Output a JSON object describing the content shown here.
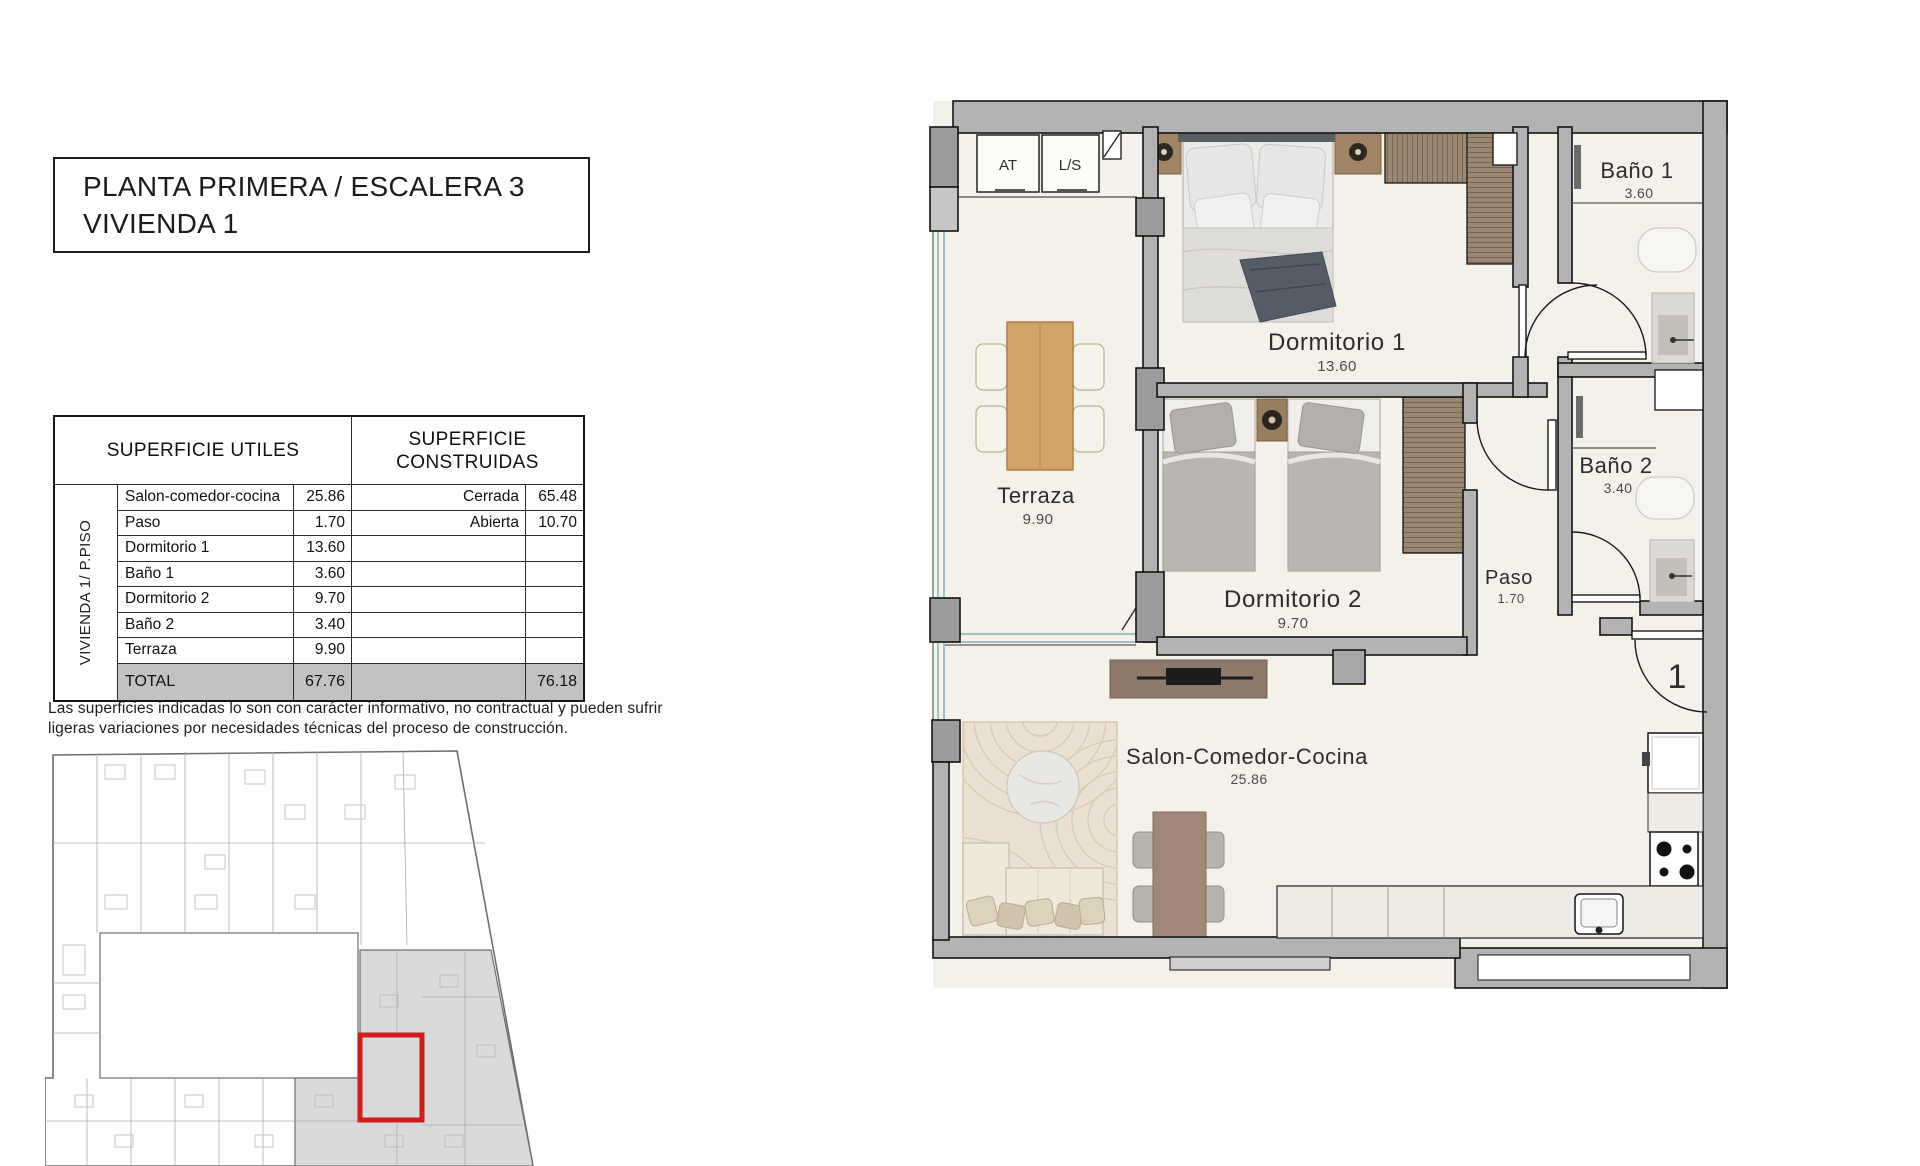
{
  "title_block": {
    "line1": "PLANTA PRIMERA / ESCALERA 3",
    "line2": "VIVIENDA 1"
  },
  "areas_table": {
    "group_label": "VIVIENDA 1/ P.PISO",
    "header_left": "SUPERFICIE UTILES",
    "header_right": "SUPERFICIE CONSTRUIDAS",
    "rows": [
      {
        "name": "Salon-comedor-cocina",
        "value": "25.86",
        "built_name": "Cerrada",
        "built_value": "65.48"
      },
      {
        "name": "Paso",
        "value": "1.70",
        "built_name": "Abierta",
        "built_value": "10.70"
      },
      {
        "name": "Dormitorio 1",
        "value": "13.60",
        "built_name": "",
        "built_value": ""
      },
      {
        "name": "Baño 1",
        "value": "3.60",
        "built_name": "",
        "built_value": ""
      },
      {
        "name": "Dormitorio 2",
        "value": "9.70",
        "built_name": "",
        "built_value": ""
      },
      {
        "name": "Baño 2",
        "value": "3.40",
        "built_name": "",
        "built_value": ""
      },
      {
        "name": "Terraza",
        "value": "9.90",
        "built_name": "",
        "built_value": ""
      }
    ],
    "total_row": {
      "label": "TOTAL",
      "useful_total": "67.76",
      "built_total": "76.18"
    }
  },
  "disclaimer": {
    "line1": "Las superficies indicadas lo son con carácter informativo, no contractual y pueden sufrir",
    "line2": "ligeras variaciones por necesidades técnicas del proceso de construcción."
  },
  "floor_plan": {
    "rooms": {
      "dormitorio1": {
        "name": "Dormitorio 1",
        "area": "13.60"
      },
      "dormitorio2": {
        "name": "Dormitorio 2",
        "area": "9.70"
      },
      "bano1": {
        "name": "Baño 1",
        "area": "3.60"
      },
      "bano2": {
        "name": "Baño 2",
        "area": "3.40"
      },
      "terraza": {
        "name": "Terraza",
        "area": "9.90"
      },
      "paso": {
        "name": "Paso",
        "area": "1.70"
      },
      "salon": {
        "name": "Salon-Comedor-Cocina",
        "area": "25.86"
      }
    },
    "utility": {
      "at": "AT",
      "ls": "L/S"
    },
    "entrance_number": "1"
  },
  "colors": {
    "wall": "#b3b3b3",
    "floor": "#f4f1ea",
    "highlight_red": "#cf1d1d"
  }
}
